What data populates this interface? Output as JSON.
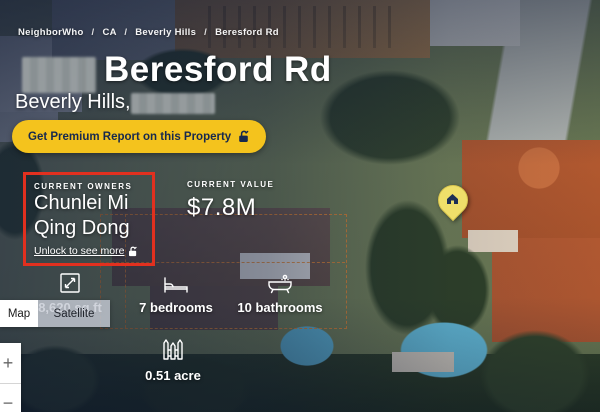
{
  "colors": {
    "brand_yellow": "#F4C31D",
    "button_text_navy": "#17294E",
    "highlight_red": "#E2301F",
    "parcel_boundary_orange": "#E28634",
    "marker_yellow": "#EFDF6A",
    "overlay_navy": "#0D1834"
  },
  "breadcrumb": {
    "separator": "/",
    "items": [
      "NeighborWho",
      "CA",
      "Beverly Hills",
      "Beresford Rd"
    ]
  },
  "header": {
    "street_name": "Beresford Rd",
    "city_line": "Beverly Hills,"
  },
  "premium_button": {
    "label": "Get Premium Report on this Property",
    "icon": "unlock-icon"
  },
  "owners": {
    "label": "CURRENT OWNERS",
    "names": [
      "Chunlei Mi",
      "Qing Dong"
    ],
    "unlock_link": "Unlock to see more",
    "unlock_icon": "unlock-icon"
  },
  "value": {
    "label": "CURRENT VALUE",
    "amount": "$7.8M"
  },
  "stats": [
    {
      "icon": "area-icon",
      "label": "8,620 sq ft"
    },
    {
      "icon": "bed-icon",
      "label": "7 bedrooms"
    },
    {
      "icon": "bath-icon",
      "label": "10 bathrooms"
    },
    {
      "icon": "fence-icon",
      "label": "0.51 acre"
    }
  ],
  "map_controls": {
    "map_label": "Map",
    "satellite_label": "Satellite",
    "zoom_in": "+",
    "zoom_out": "−"
  },
  "map_marker": {
    "icon": "house-pin-icon"
  }
}
